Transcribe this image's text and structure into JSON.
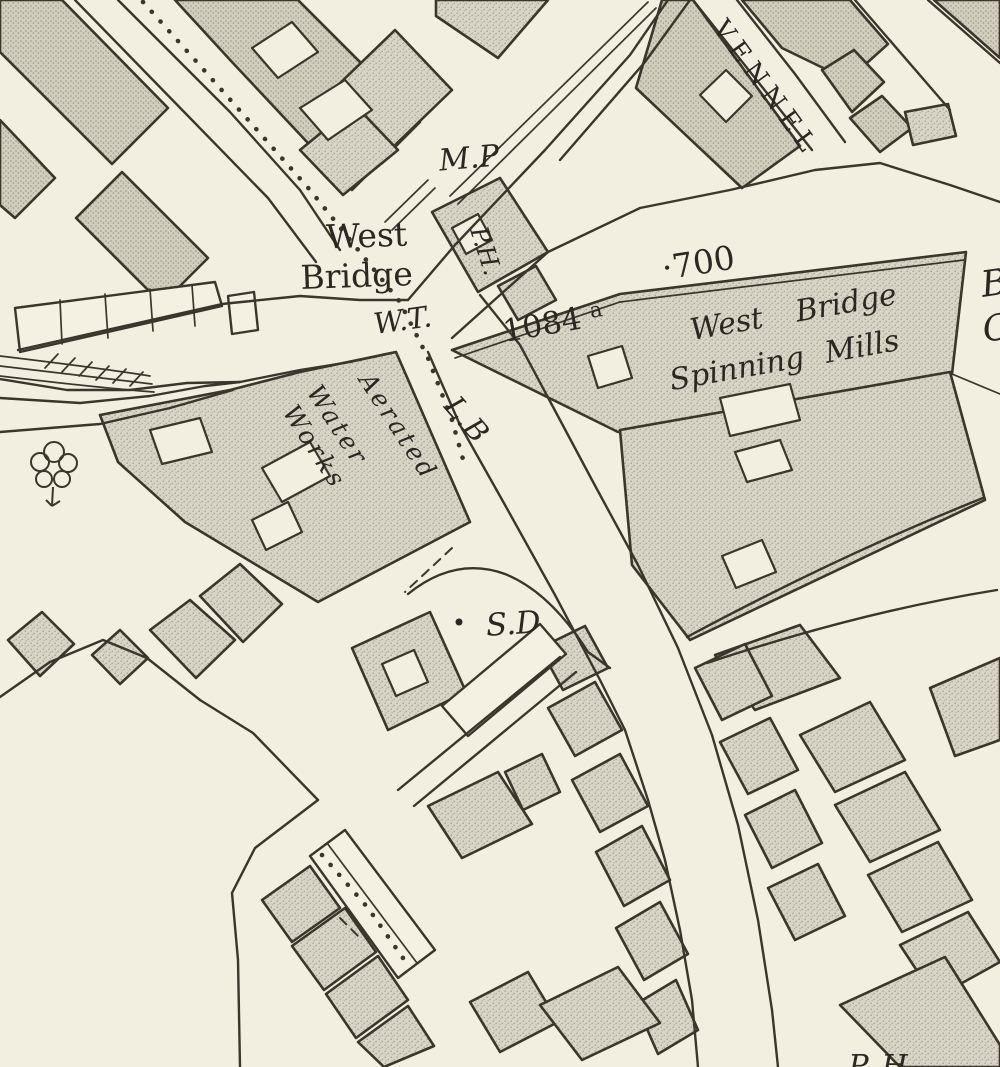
{
  "map": {
    "labels": {
      "milepost": "M.P",
      "west": "West",
      "bridge": "Bridge",
      "public_house": "P.H.",
      "water_trough": "W.T.",
      "parcel_number": "1084",
      "parcel_suffix": "a",
      "spot_700": "·700",
      "mills_line1": "West Bridge",
      "mills_line2": "Spinning Mills",
      "street_vennel": "VENNEL",
      "works_line1": "Aerated",
      "works_line2": "Water",
      "works_line3": "Works",
      "letter_box": "L.B",
      "sanitary_depot": "S.D",
      "edge_letter_b": "B",
      "edge_letter_c": "C",
      "bottom_partial": "P. H"
    },
    "colors": {
      "paper": "#f2eee0",
      "building_fill": "#d9d5c6",
      "building_stipple": "#a9a596",
      "ink": "#3a362c",
      "text_ink": "#2b2823"
    }
  }
}
